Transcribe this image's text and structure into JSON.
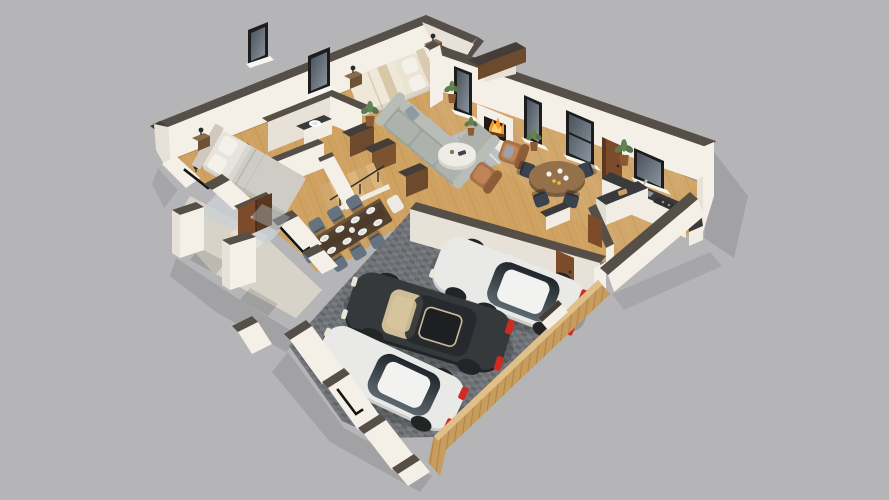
{
  "canvas": {
    "width": 889,
    "height": 500
  },
  "scene": {
    "kind": "isometric-3d-cutaway-floor-plan-render",
    "background_note": "flat gray studio backdrop",
    "storeys_visible": 1
  },
  "palette": {
    "background": "#b5b5b7",
    "wallTop": "#564f48",
    "wallTopDark": "#453e38",
    "wallFaceLight": "#f4f0e8",
    "wallFaceShadow": "#e7e1d8",
    "wallFaceDim": "#dbd4ca",
    "floorWood": "#d0a262",
    "porch": "#d8d3c9",
    "paver": "#74777b",
    "garageWood": "#c79c5c",
    "garageWoodDark": "#a87f43",
    "windowFrame": "#1d1d1f",
    "doorBrown": "#7b4b2a",
    "doorBrownDark": "#5a3820",
    "sofa": "#adb2ad",
    "sofaLight": "#b9bdb8",
    "sofaDark": "#9ea39e",
    "rugLiving": "#b9c0c6",
    "rugBedroom": "#ccd1d5",
    "bedSheet": "#e7e4dd",
    "bedBlanket": "#cfccc6",
    "headboard1": "#cfc9bf",
    "bedBeige": "#ece4d3",
    "headboard2": "#d9cbb1",
    "pillow": "#f3f1ea",
    "marble": "#efece6",
    "leather": "#a9714a",
    "tableWood": "#53402f",
    "chairSlate": "#64737f",
    "chairDark": "#3a434d",
    "counterTop": "#3a3a3c",
    "cabinet": "#f1ede4",
    "applianceDark": "#2e2f31",
    "carWhite": "#e9e9e8",
    "carWhiteShade": "#cbcccc",
    "carDark": "#35393c",
    "carDarkShade": "#222527",
    "wheel": "#222426",
    "taillight": "#cf2b20",
    "headlight": "#e8e6da",
    "fire": "#ff9726",
    "fireLight": "#ffd27a",
    "ember": "#6e3a14",
    "plant": "#5d7b4c",
    "pot": "#8a5a33",
    "stairWood": "#d8b077",
    "matGray": "#9aa0a4",
    "plate": "#f2f1ed"
  },
  "inventory": {
    "rooms": [
      "master-bedroom",
      "second-bedroom",
      "bathroom",
      "closet",
      "hallway-stairs",
      "living-room",
      "dining-area",
      "breakfast-area",
      "kitchen",
      "entry-porch",
      "garage"
    ],
    "furniture": [
      "double-bed-gray",
      "double-bed-beige",
      "nightstands",
      "wall-lamps",
      "sectional-sofa",
      "round-coffee-table",
      "leather-armchairs",
      "fireplace-with-fire",
      "rectangular-dining-table",
      "dining-chairs",
      "round-breakfast-table",
      "kitchen-counter",
      "kitchen-island",
      "sink",
      "cooktop",
      "bathroom-vanity",
      "staircase",
      "wardrobes",
      "potted-plants"
    ],
    "vehicles": [
      "white-hatchback-rear",
      "dark-suv",
      "white-hatchback-front"
    ],
    "exterior": [
      "porch-pillars",
      "front-door",
      "wooden-garage-doors",
      "paver-garage-floor",
      "cut-wall-window-lines"
    ]
  }
}
